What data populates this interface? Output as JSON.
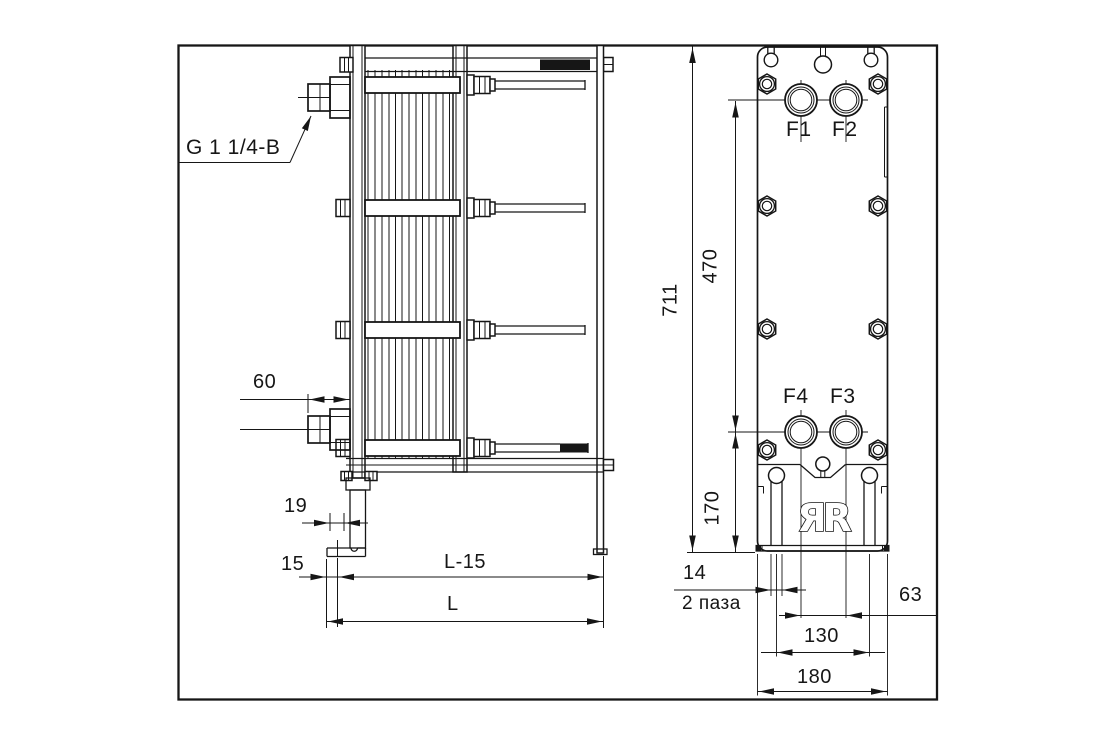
{
  "side_view": {
    "connection_label": "G 1 1/4-B",
    "dims": {
      "conn_projection": "60",
      "foot_slot": "19",
      "foot_edge": "15",
      "length_minus": "L-15",
      "length": "L"
    }
  },
  "front_view": {
    "ports": {
      "f1": "F1",
      "f2": "F2",
      "f3": "F3",
      "f4": "F4"
    },
    "dims": {
      "height": "711",
      "ports_vertical": "470",
      "ports_bottom": "170",
      "slot_width": "14",
      "slot_note": "2 паза",
      "ports_horizontal": "63",
      "slots_spacing": "130",
      "width": "180"
    },
    "logo": "ЯR"
  }
}
